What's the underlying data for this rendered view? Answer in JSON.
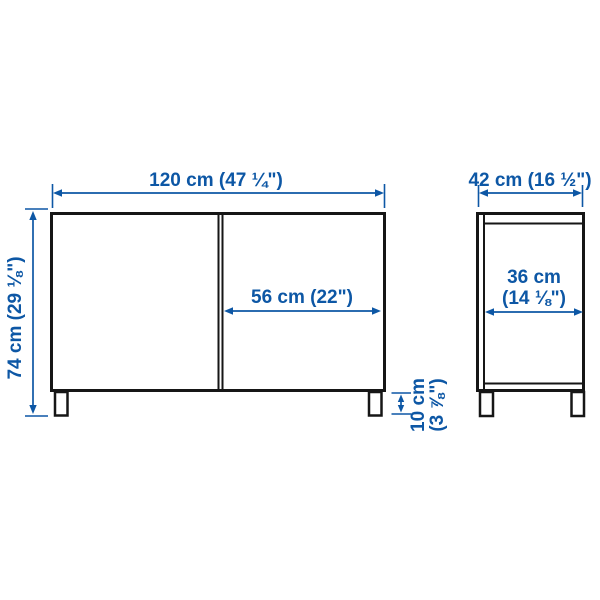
{
  "diagram": {
    "product_type": "two-door storage cabinet dimension drawing",
    "front_view": {
      "width_label": "120 cm (47 ¼\")",
      "height_label": "74 cm (29 ⅛\")",
      "door_width_label": "56 cm (22\")",
      "leg_height_label_line1": "10 cm",
      "leg_height_label_line2": "(3 ⅞\")"
    },
    "side_view": {
      "depth_label": "42 cm (16 ½\")",
      "inner_depth_label_line1": "36 cm",
      "inner_depth_label_line2": "(14 ⅛\")"
    }
  },
  "colors": {
    "dimension_blue": "#0d57a5",
    "outline_dark": "#161616",
    "background": "#ffffff"
  }
}
